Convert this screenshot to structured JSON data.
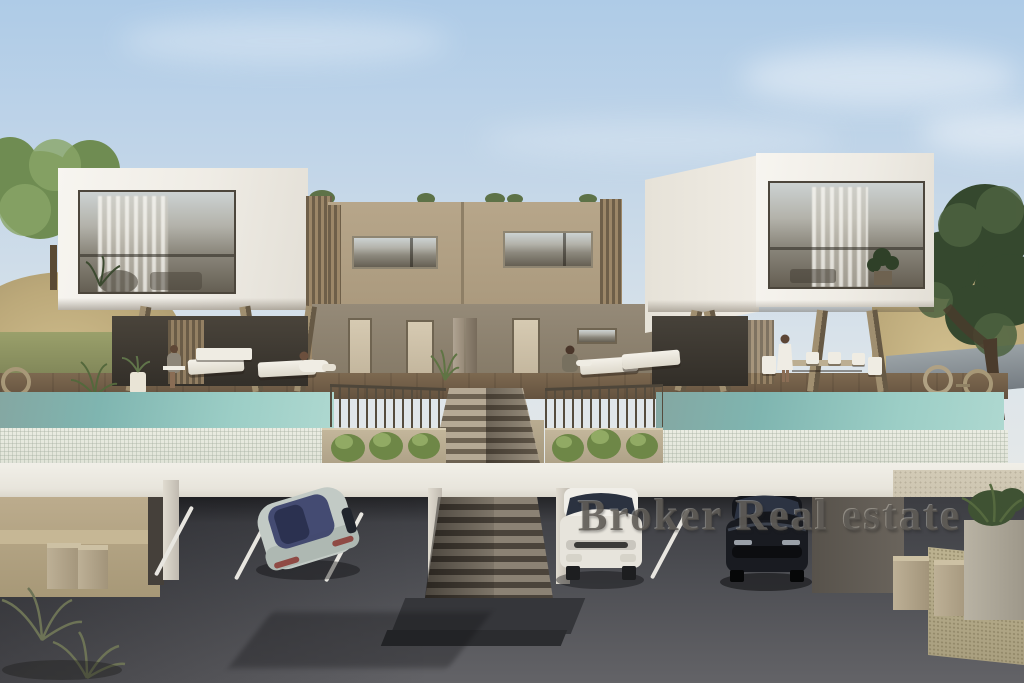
{
  "watermark": {
    "text": "Broker Real estate"
  },
  "palette": {
    "sky_top": "#aecbe7",
    "sky_horizon": "#e7e9e8",
    "white_volume": "#f3f0ea",
    "upper_wall_tan": "#b2a186",
    "lower_wall_taupe": "#8b8071",
    "deck_wood": "#6f5c47",
    "pool_water": "#7fb5b0",
    "pool_tile": "#e6e9df",
    "fascia_concrete": "#edebe4",
    "garage_asphalt": "#46474c",
    "sand_dune": "#c4b283",
    "foliage_dark": "#3c4f31",
    "foliage_light": "#7f9a5c",
    "watermark_gray": "#54514c"
  }
}
